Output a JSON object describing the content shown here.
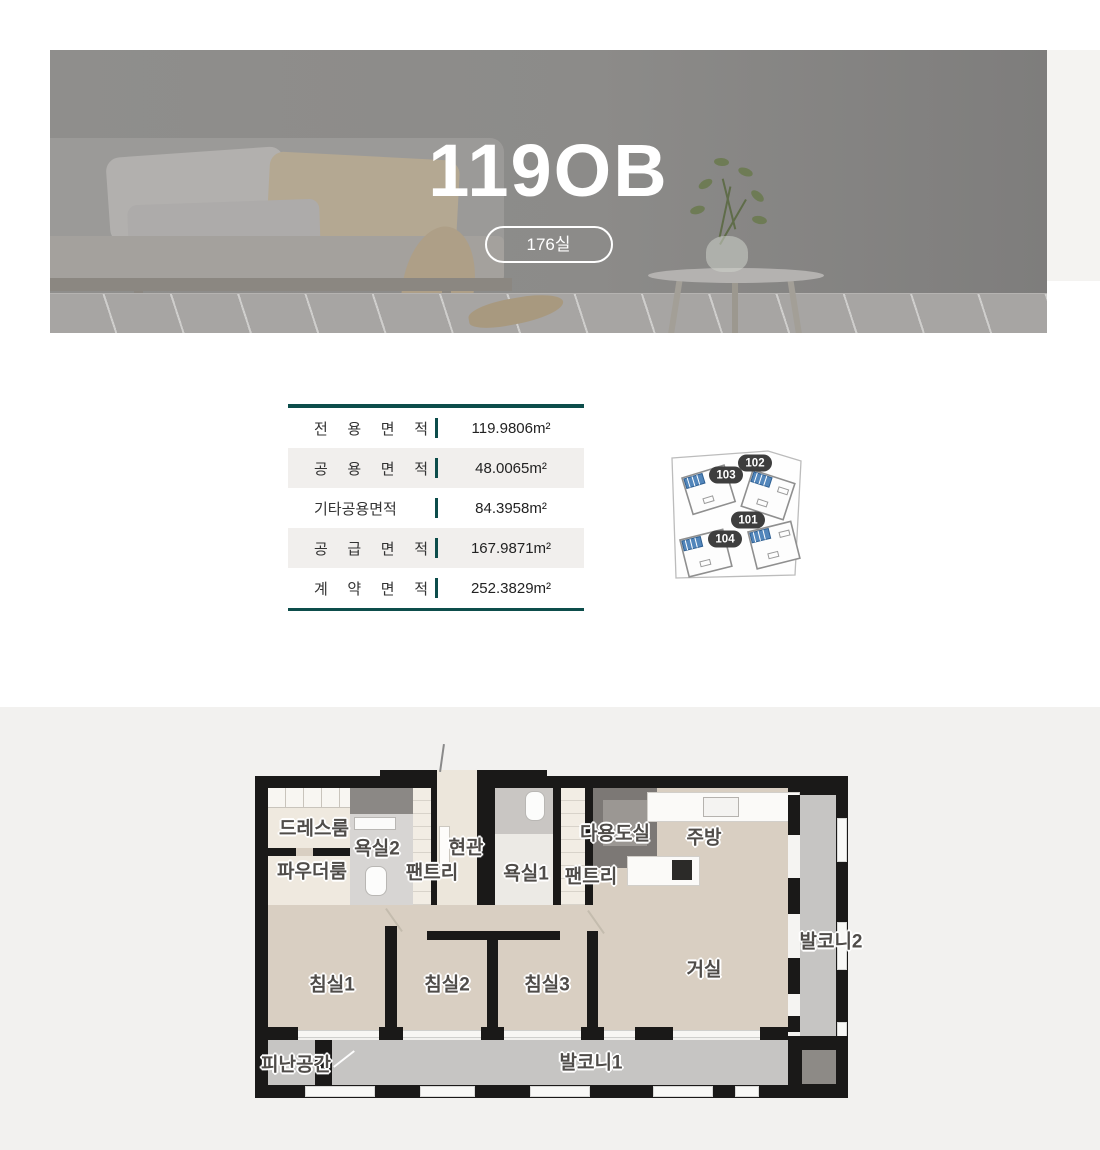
{
  "hero": {
    "title": "119OB",
    "badge": "176실"
  },
  "area_table": {
    "rows": [
      {
        "label": "전 용 면 적",
        "value": "119.9806m²"
      },
      {
        "label": "공 용 면 적",
        "value": "48.0065m²"
      },
      {
        "label": "기타공용면적",
        "value": "84.3958m²"
      },
      {
        "label": "공 급 면 적",
        "value": "167.9871m²"
      },
      {
        "label": "계 약 면 적",
        "value": "252.3829m²"
      }
    ]
  },
  "key_plan": {
    "units": [
      {
        "id": "102"
      },
      {
        "id": "103"
      },
      {
        "id": "101"
      },
      {
        "id": "104"
      }
    ],
    "highlight_color": "#5286bb"
  },
  "floor_plan": {
    "labels": [
      {
        "text": "드레스룸"
      },
      {
        "text": "욕실2"
      },
      {
        "text": "팬트리"
      },
      {
        "text": "현관"
      },
      {
        "text": "파우더룸"
      },
      {
        "text": "욕실1"
      },
      {
        "text": "팬트리"
      },
      {
        "text": "다용도실"
      },
      {
        "text": "주방"
      },
      {
        "text": "발코니2"
      },
      {
        "text": "침실1"
      },
      {
        "text": "침실2"
      },
      {
        "text": "침실3"
      },
      {
        "text": "거실"
      },
      {
        "text": "피난공간"
      },
      {
        "text": "발코니1"
      }
    ],
    "colors": {
      "wall": "#1a1918",
      "room": "#d9cfc2",
      "balcony": "#c6c5c3",
      "accent": "#0d4d4b"
    }
  }
}
